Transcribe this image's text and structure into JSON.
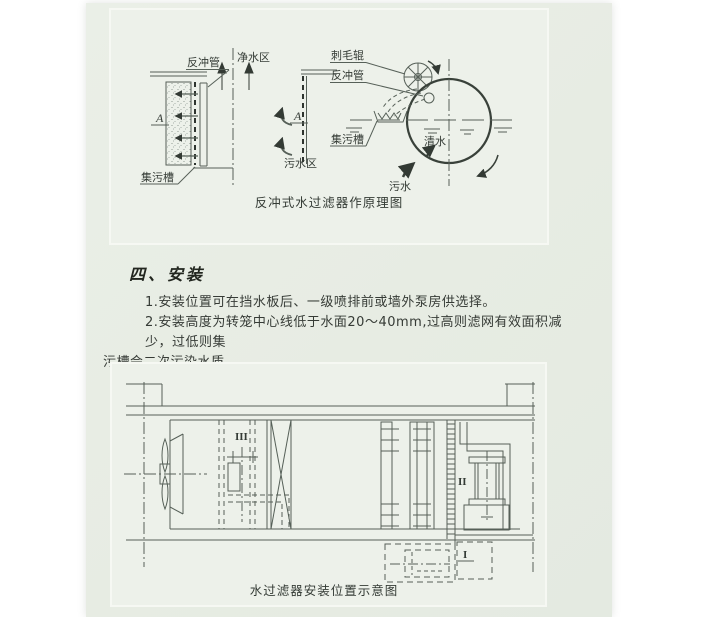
{
  "page": {
    "heading": "四、安装",
    "para1": "1.安装位置可在挡水板后、一级喷排前或墙外泵房供选择。",
    "para2_line1": "2.安装高度为转笼中心线低于水面20～40mm,过高则滤网有效面积减少，过低则集",
    "para2_line2": "污槽会二次污染水质。"
  },
  "figure_principle": {
    "caption": "反冲式水过滤器作原理图",
    "labels": {
      "backwash_pipe": "反冲管",
      "clean_water_zone": "净水区",
      "section_a": "A",
      "sewage_zone": "污水区",
      "dirt_trough": "集污槽",
      "brush_roller": "刺毛辊",
      "backwash_pipe_2": "反冲管",
      "dirt_trough_2": "集污槽",
      "clean_water": "清水",
      "sewage": "污水"
    }
  },
  "figure_layout": {
    "caption": "水过滤器安装位置示意图",
    "labels": {
      "item_I": "I",
      "item_II": "II",
      "item_III": "III"
    }
  },
  "colors": {
    "page_background": "#e8ede5",
    "figure_background": "#edf1ea",
    "figure_border": "#f6f8f3",
    "diagram_line": "#566058",
    "text": "#363b36"
  }
}
